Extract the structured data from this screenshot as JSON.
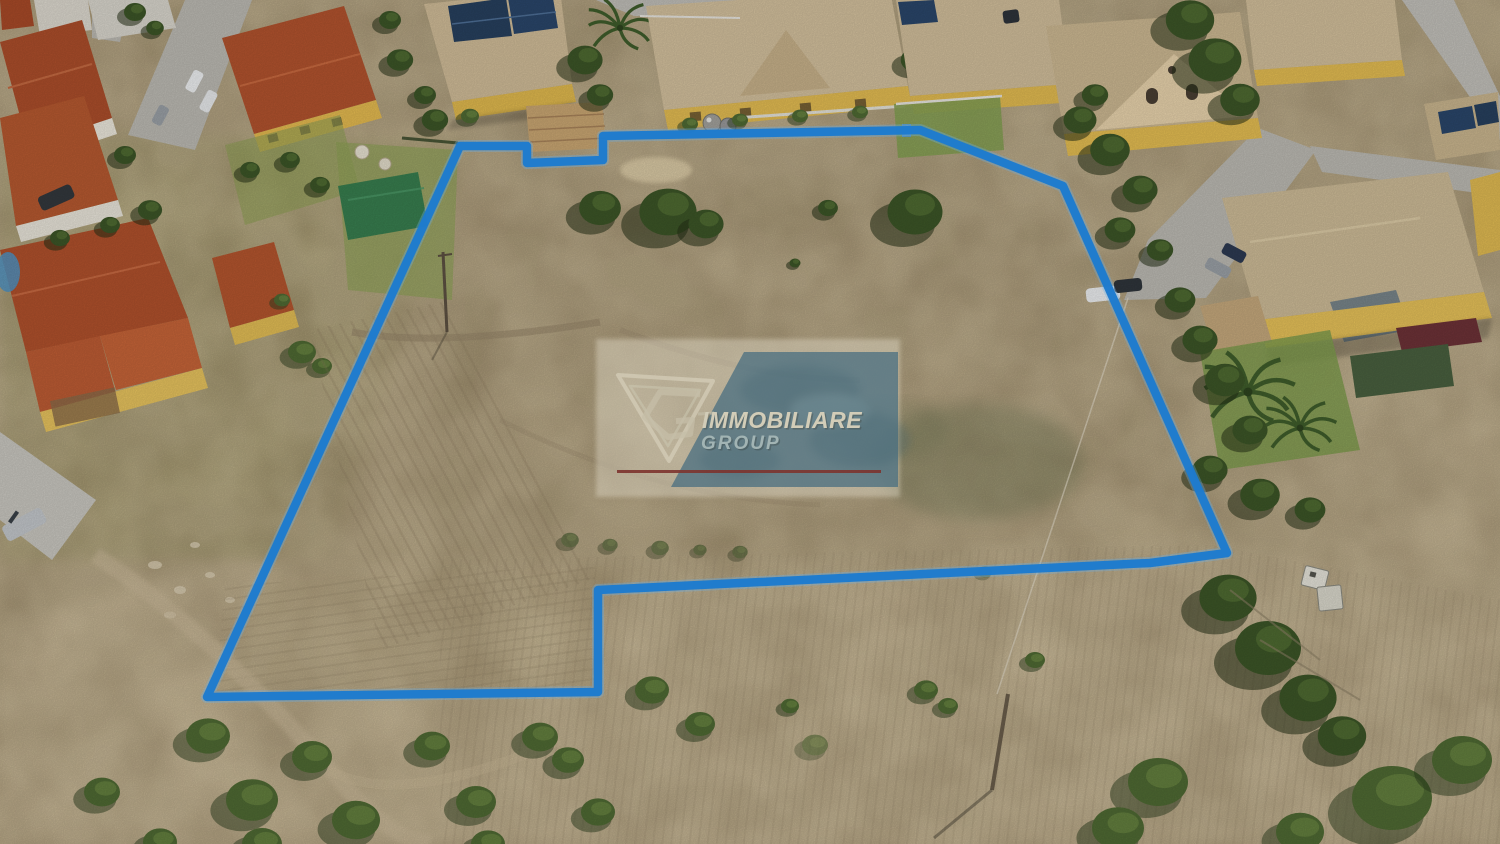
{
  "photo": {
    "description": "Aerial drone photo of a dry building plot outlined in blue, surrounded by yellow two-storey villas with terracotta and tan roofs, gardens, roads and a dry field with scattered bushes below",
    "plot_outline_points": "460,146 527,146 527,163 603,160 603,136 920,130 1063,186 1227,553 1150,563 598,590 598,692 207,697",
    "outline_color": "#1d7bce",
    "outline_glow_color": "#6ab0e8"
  },
  "watermark": {
    "brand_line1": "IMMOBILIARE",
    "brand_line2": "GROUP",
    "logo": "fg-triangle-logo",
    "panel_color": "#ece6d6",
    "band_color": "#4a7083",
    "line1_color": "#d8d3bf",
    "line2_color": "#a3b8ba",
    "underline_color": "#7b2e29"
  }
}
